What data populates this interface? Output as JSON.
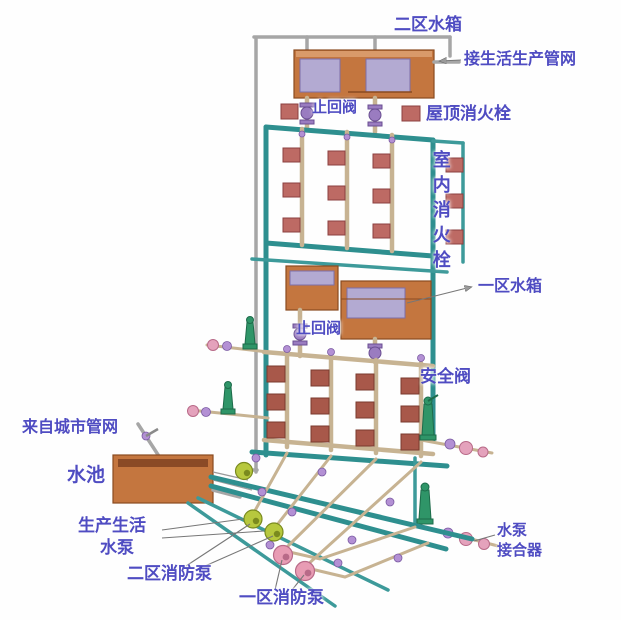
{
  "diagram": {
    "labels": {
      "zone2_tank": "二区水箱",
      "to_domestic_production_network": "接生活生产管网",
      "check_valve_upper": "止回阀",
      "roof_hydrant": "屋顶消火栓",
      "indoor_hydrant": "室内消火栓",
      "zone1_tank": "一区水箱",
      "check_valve_lower": "止回阀",
      "safety_valve": "安全阀",
      "from_city_network": "来自城市管网",
      "pool": "水池",
      "domestic_pump_line1": "生产生活",
      "domestic_pump_line2": "水泵",
      "zone2_fire_pump": "二区消防泵",
      "zone1_fire_pump": "一区消防泵",
      "pump_adapter_line1": "水泵",
      "pump_adapter_line2": "接合器"
    },
    "colors": {
      "label_text": "#4f4cc2",
      "tank_orange": "#c4763f",
      "water_panel": "#b3aad2",
      "pipe_teal": "#2e8f8f",
      "pipe_beige": "#c7b392",
      "pipe_gray": "#a6a6a6",
      "hydrant_box_upper": "#bd6a64",
      "hydrant_box_lower": "#a8584a",
      "check_valve_purple": "#9a7cc0",
      "safety_valve_green": "#2f9568",
      "domestic_pump_green": "#b7c83e",
      "fire_pump_pink": "#e89cb4",
      "background": "#fefefe"
    }
  }
}
